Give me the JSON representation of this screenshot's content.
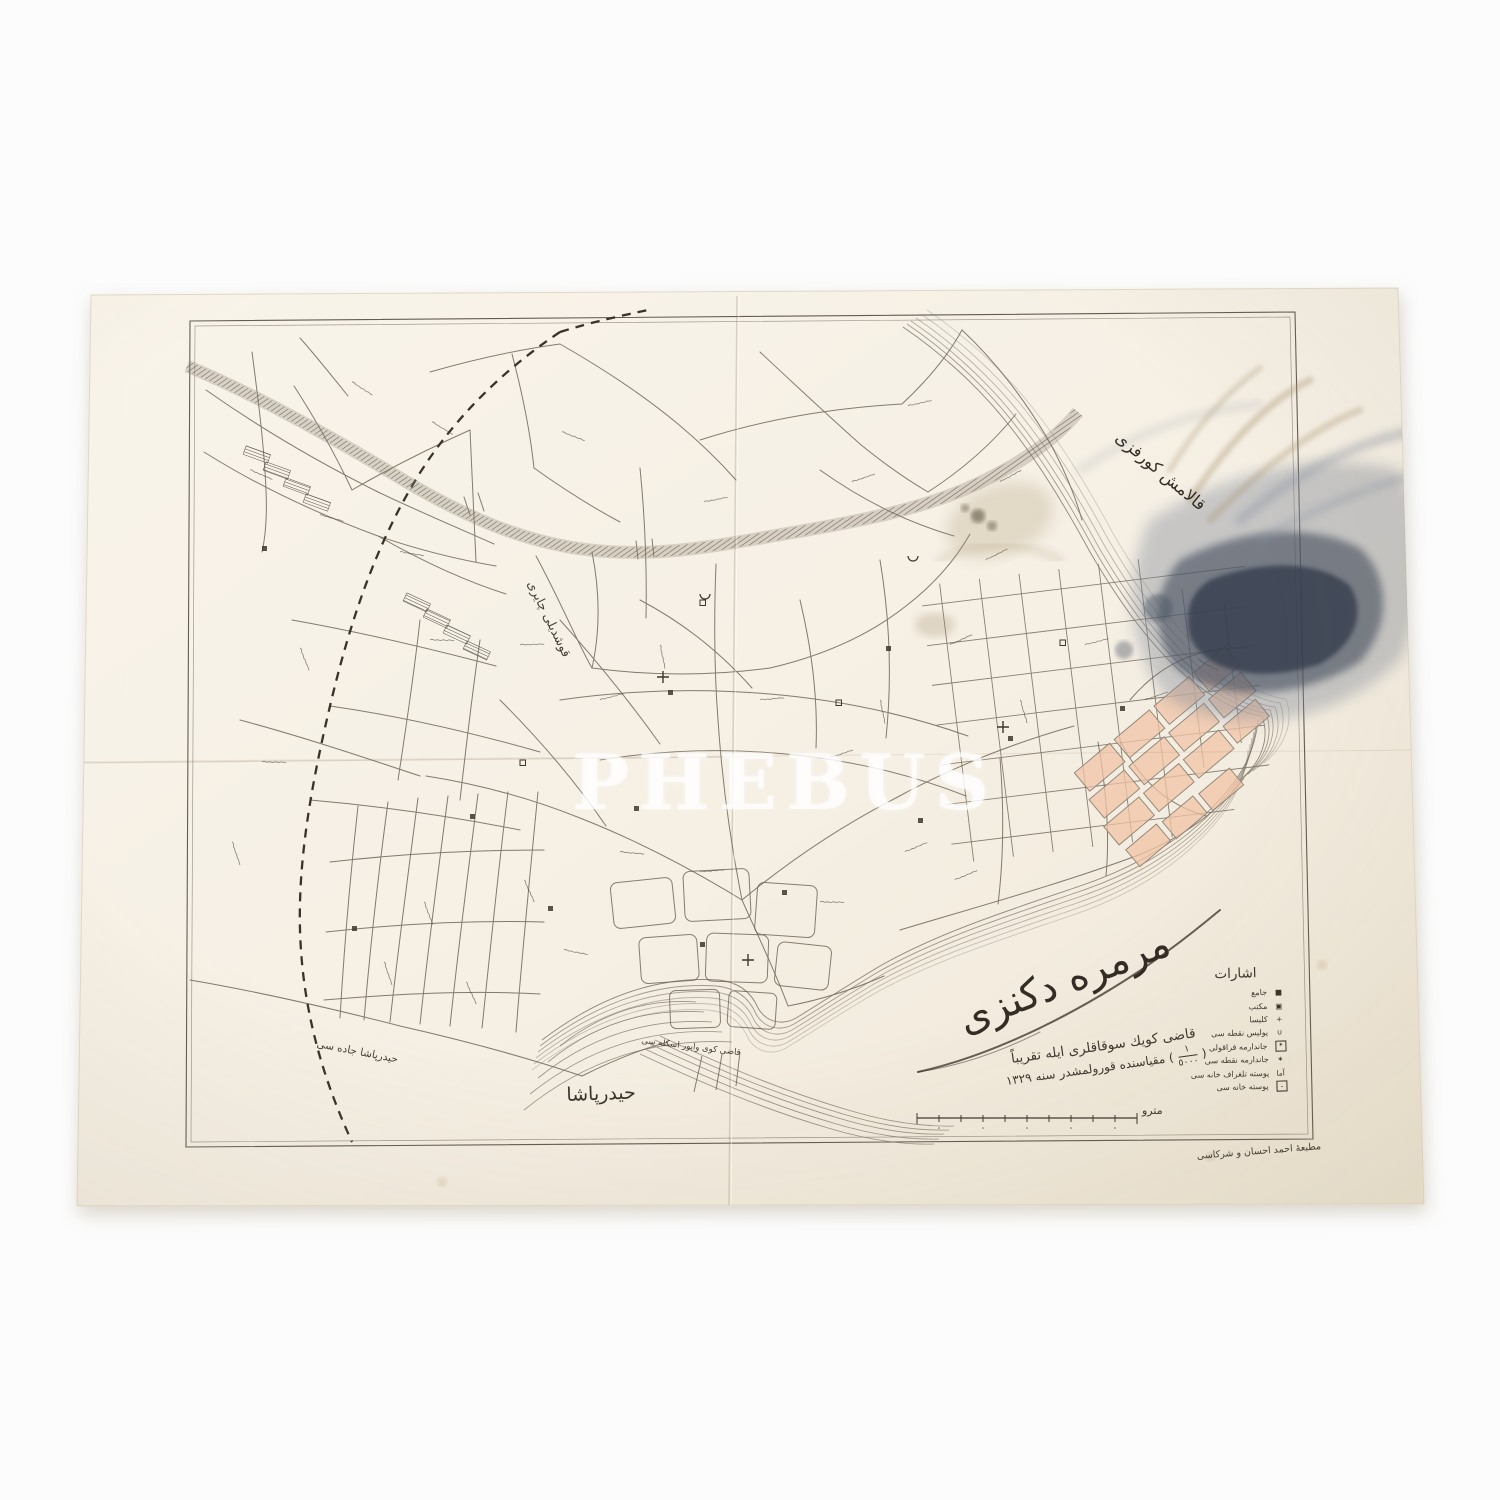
{
  "photo": {
    "background": "#fcfcfc",
    "paper_color": "#f5efe4",
    "ink_color": "#5b5348",
    "stain_color": "#49525f",
    "pink_block_color": "#f0c3a5"
  },
  "watermark": {
    "text": "PHEBUS"
  },
  "map": {
    "labels": {
      "gulf": "قالامش كورفزى",
      "sea": "مرمره دكنزى",
      "meadow": "قوشديلى چايرى",
      "district": "حيدرپاشا",
      "road": "حيدرپاشا جاده سى",
      "pier": "قاضى كوى واپور اسكله سى"
    },
    "title": {
      "line1": "قاضى كويك سوقاقلرى ايله تقريباً",
      "paren_open": "(",
      "fraction_numerator": "١",
      "fraction_denominator": "٥٠٠٠",
      "paren_close": ")",
      "line2": "مقياسنده قورولمشدر",
      "year": "سنه ١٣٢٩"
    },
    "legend": {
      "heading": "اشارات",
      "items": [
        {
          "label": "جامع",
          "glyph": "■"
        },
        {
          "label": "مكتب",
          "glyph": "▣"
        },
        {
          "label": "كليسا",
          "glyph": "+"
        },
        {
          "label": "پوليس نقطه سى",
          "glyph": "∪"
        },
        {
          "label": "جاندارمه قراقولى",
          "glyph": "✶"
        },
        {
          "label": "جاندارمه نقطه سى",
          "glyph": "✶"
        },
        {
          "label": "پوسته تلغراف خانه سى",
          "glyph": "آما"
        },
        {
          "label": "پوسته خانه سى",
          "glyph": "ـ"
        }
      ]
    },
    "scale": {
      "unit": "مترو"
    },
    "imprint": "مطبعهٔ احمد احسان و شركاسى"
  }
}
